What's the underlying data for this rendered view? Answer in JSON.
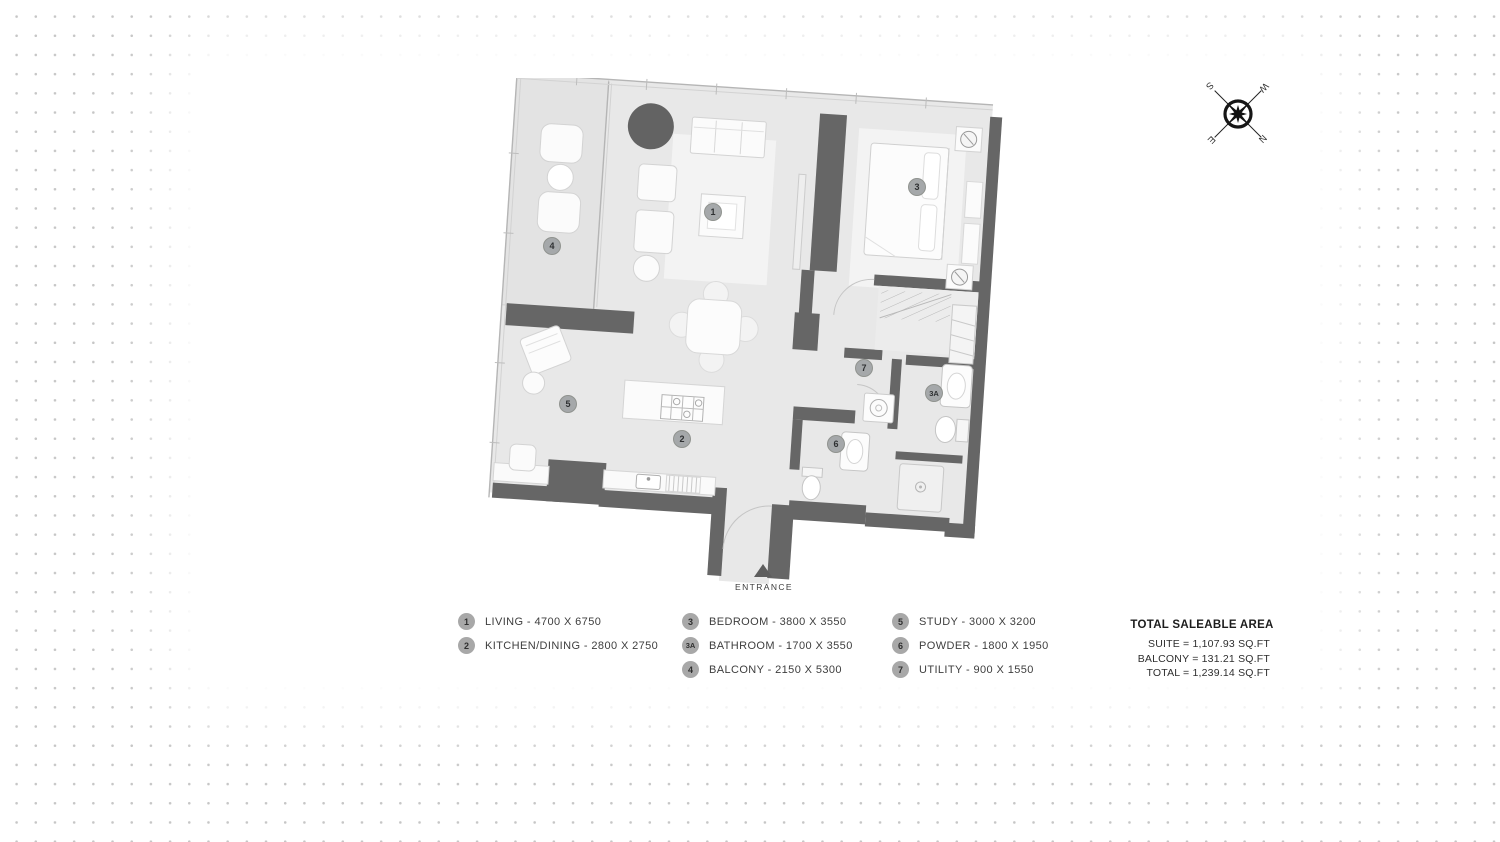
{
  "colors": {
    "wall": "#666666",
    "floor": "#e8e8e8",
    "balcony_floor": "#e3e3e3",
    "furniture_fill": "#fbfbfb",
    "furniture_stroke": "#d3d3d3",
    "marker_fill": "#a5a8aa",
    "background_dots": "#c6c6c6",
    "dark_accent_circle": "#636363"
  },
  "compass": {
    "north": "N",
    "east": "E",
    "south": "S",
    "west": "W"
  },
  "plan": {
    "entrance_label": "ENTRANCE",
    "markers": [
      {
        "id": "1",
        "room": "living"
      },
      {
        "id": "2",
        "room": "kitchen-dining"
      },
      {
        "id": "3",
        "room": "bedroom"
      },
      {
        "id": "3A",
        "room": "bathroom"
      },
      {
        "id": "4",
        "room": "balcony"
      },
      {
        "id": "5",
        "room": "study"
      },
      {
        "id": "6",
        "room": "powder"
      },
      {
        "id": "7",
        "room": "utility"
      }
    ]
  },
  "legend": {
    "columns": [
      {
        "items": [
          {
            "badge": "1",
            "label": "LIVING - 4700 X 6750"
          },
          {
            "badge": "2",
            "label": "KITCHEN/DINING - 2800 X 2750"
          }
        ]
      },
      {
        "items": [
          {
            "badge": "3",
            "label": "BEDROOM - 3800 X 3550"
          },
          {
            "badge": "3A",
            "label": "BATHROOM - 1700 X 3550"
          },
          {
            "badge": "4",
            "label": "BALCONY - 2150 X 5300"
          }
        ]
      },
      {
        "items": [
          {
            "badge": "5",
            "label": "STUDY - 3000 X 3200"
          },
          {
            "badge": "6",
            "label": "POWDER - 1800 X 1950"
          },
          {
            "badge": "7",
            "label": "UTILITY - 900 X 1550"
          }
        ]
      }
    ]
  },
  "area_summary": {
    "title": "TOTAL SALEABLE AREA",
    "rows": [
      "SUITE = 1,107.93  SQ.FT",
      "BALCONY = 131.21  SQ.FT",
      "TOTAL = 1,239.14  SQ.FT"
    ]
  }
}
